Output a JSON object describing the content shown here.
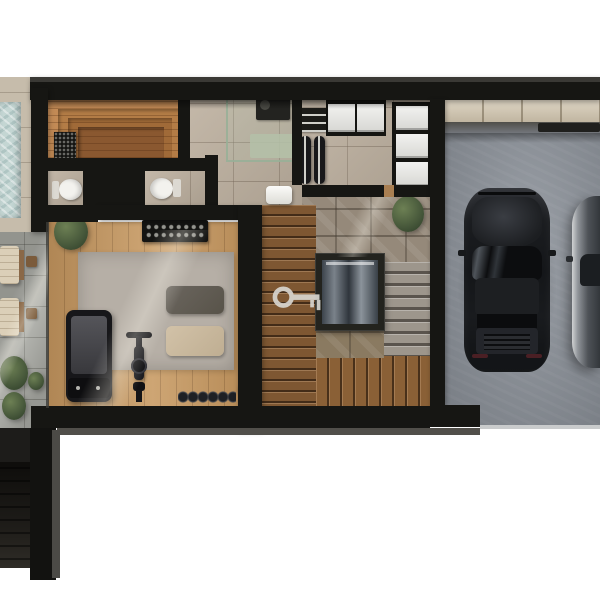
{
  "scene": {
    "kind": "architectural floor plan, 3D top-down render",
    "level": "basement with gym, sauna and two-car garage",
    "background": "#ffffff",
    "visible_text": "none"
  },
  "palette": {
    "wall": "#161613",
    "wood_floor": "#c89b64",
    "sauna_wood": "#c28a55",
    "stone_tile": "#bdb09f",
    "rough_stone": "#95897a",
    "stair_wood": "#7e5732",
    "concrete_garage": "#8b9199",
    "pavers": "#a7a8a2",
    "pool_water": "#c4d6d3",
    "rug": "#b6afa6",
    "plant_green": "#46573a",
    "car_black": "#141619",
    "appliance_white": "#eeeeec",
    "key_marker": "#d8d5cf"
  },
  "rooms": {
    "pool_terrace": {
      "name": "pool terrace"
    },
    "sauna": {
      "name": "sauna"
    },
    "wc_left": {
      "name": "toilet room left"
    },
    "wc_middle": {
      "name": "toilet room middle"
    },
    "bathroom": {
      "name": "shower bathroom"
    },
    "laundry": {
      "name": "laundry utility room"
    },
    "gym": {
      "name": "home gym"
    },
    "stair_hall": {
      "name": "stair hall with glass elevator"
    },
    "garage": {
      "name": "two-car garage"
    },
    "exterior_stair": {
      "name": "exterior stair bottom-left"
    }
  },
  "objects": {
    "pool": "swimming pool, cropped at left edge",
    "sun_loungers": 2,
    "sauna_heater": "sauna stove",
    "sauna_benches": "stepped wooden benches",
    "toilets": 2,
    "shower": "glass shower enclosure",
    "washbasin": "white washbasin",
    "washer_dryer_units": 2,
    "water_tanks": 2,
    "utility_shelf": 1,
    "storage_boxes": 3,
    "treadmill": 1,
    "exercise_bike": 1,
    "yoga_mats": 2,
    "dumbbell_rack": 1,
    "free_weight_row": 1,
    "medicine_ball": 1,
    "area_rug": 1,
    "wall_panel": 1,
    "elevator": "glass elevator cab",
    "wood_staircase": "U-shaped wooden stair around elevator",
    "stone_steps": "stone treads right of elevator",
    "key_marker": "light key-shaped marker on stairs",
    "cars": 2,
    "plants": 5
  }
}
